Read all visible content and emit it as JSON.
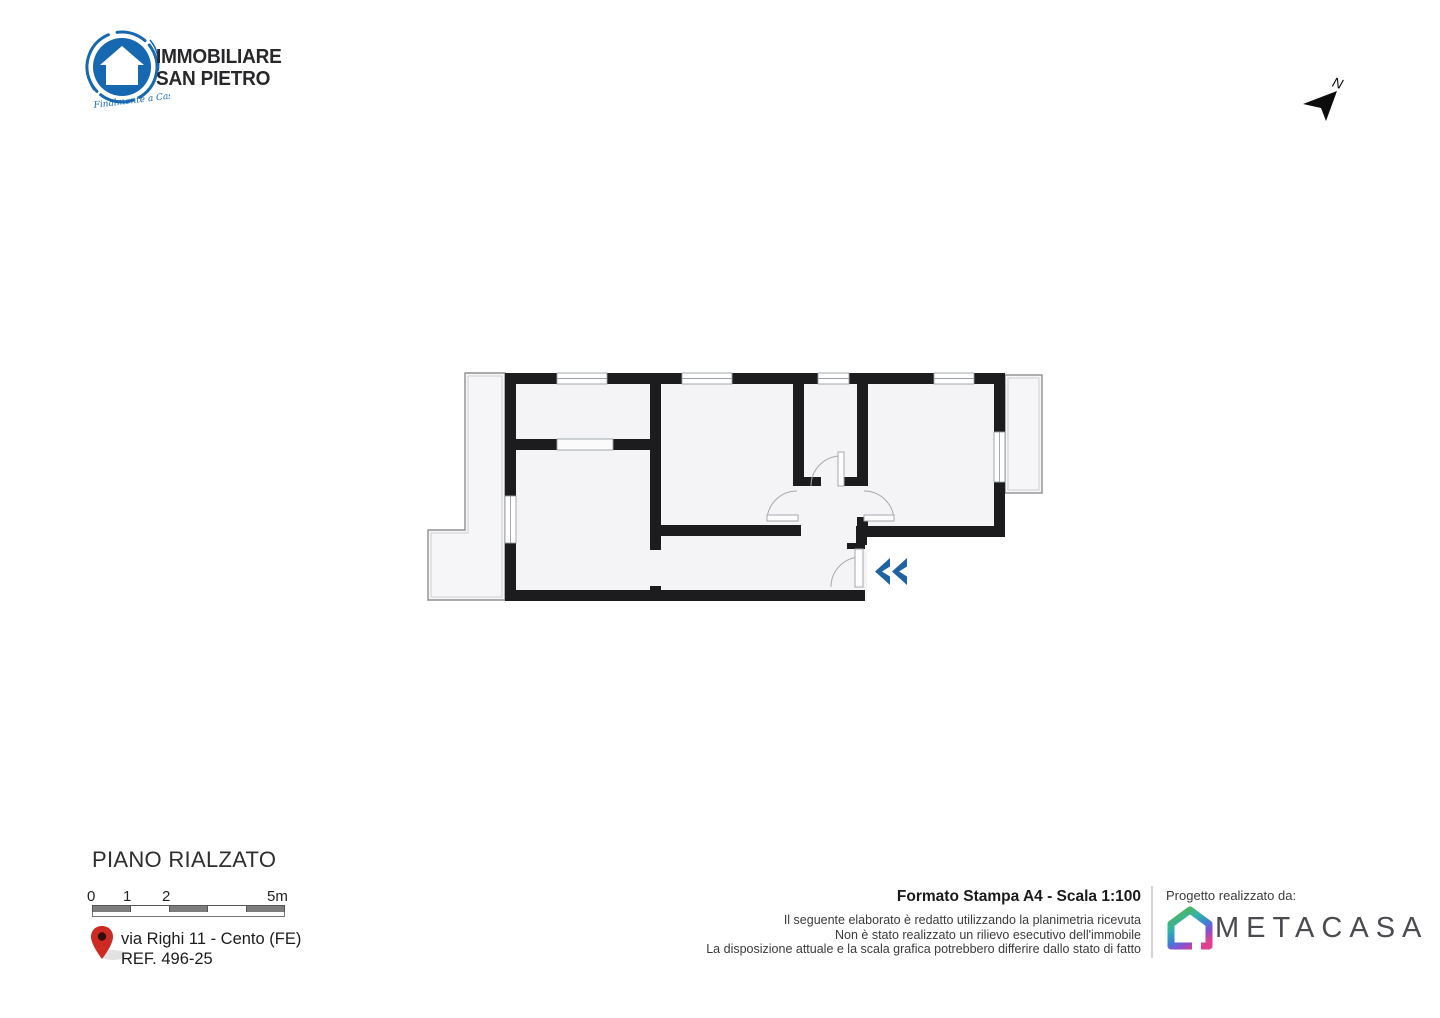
{
  "brand": {
    "line1": "IMMOBILIARE",
    "line2": "SAN PIETRO",
    "tagline": "Finalmente a Casa",
    "logo_color": "#1668b0"
  },
  "compass": {
    "label": "N"
  },
  "plan": {
    "title": "PIANO RIALZATO",
    "wall_color": "#1c1c1e",
    "floor_color": "#f4f4f6",
    "entrance_arrow_color": "#1e63a4"
  },
  "scale_bar": {
    "labels": [
      "0",
      "1",
      "2",
      "5m"
    ],
    "dark_segment_color": "#7d7d7d"
  },
  "location": {
    "address": "via Righi 11 - Cento (FE)",
    "ref": "REF. 496-25",
    "pin_color": "#cc2a22"
  },
  "print_info": {
    "format": "Formato Stampa A4 - Scala 1:100",
    "disclaimer": [
      "Il seguente elaborato è redatto utilizzando la planimetria ricevuta",
      "Non è stato realizzato un rilievo esecutivo dell'immobile",
      "La disposizione attuale e la scala grafica potrebbero differire dallo stato di fatto"
    ]
  },
  "credit": {
    "label": "Progetto realizzato da:",
    "partner": "METACASA"
  }
}
